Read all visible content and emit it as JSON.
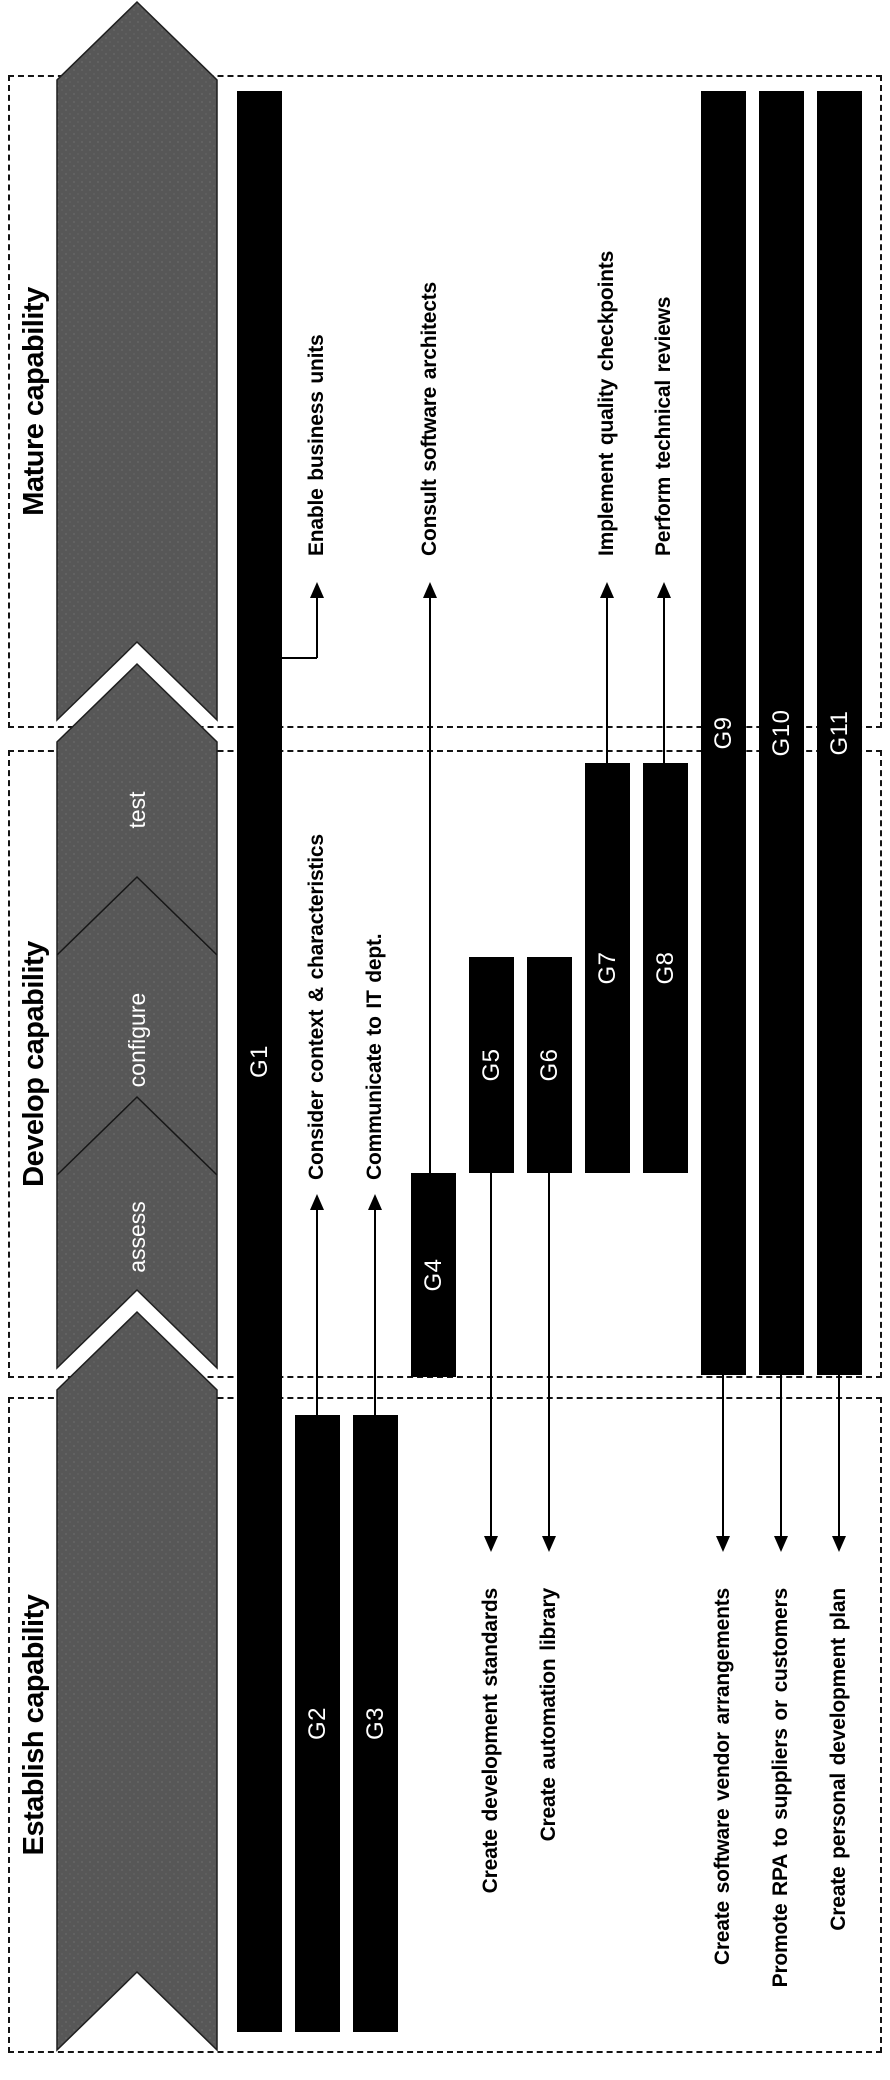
{
  "colors": {
    "background": "#ffffff",
    "arrow_gray": "#575757",
    "arrow_dot_texture": "#666666",
    "arrow_edge": "#1f1f1f",
    "bar_fill": "#000000",
    "bar_label_color": "#ffffff",
    "dashed_border": "#141414",
    "text_color": "#000000"
  },
  "phases": [
    {
      "id": "establish",
      "label": "Establish capability",
      "sub_phases": []
    },
    {
      "id": "develop",
      "label": "Develop capability",
      "sub_phases": [
        "assess",
        "configure",
        "test"
      ]
    },
    {
      "id": "mature",
      "label": "Mature capability",
      "sub_phases": []
    }
  ],
  "bars": [
    {
      "id": "G1",
      "label": "G1",
      "x": 48,
      "width": 1941,
      "y": 237
    },
    {
      "id": "G2",
      "label": "G2",
      "x": 48,
      "width": 617,
      "y": 295
    },
    {
      "id": "G3",
      "label": "G3",
      "x": 48,
      "width": 617,
      "y": 353
    },
    {
      "id": "G4",
      "label": "G4",
      "x": 703,
      "width": 204,
      "y": 411
    },
    {
      "id": "G5",
      "label": "G5",
      "x": 907,
      "width": 216,
      "y": 469
    },
    {
      "id": "G6",
      "label": "G6",
      "x": 907,
      "width": 216,
      "y": 527
    },
    {
      "id": "G7",
      "label": "G7",
      "x": 907,
      "width": 410,
      "y": 585
    },
    {
      "id": "G8",
      "label": "G8",
      "x": 907,
      "width": 410,
      "y": 643
    },
    {
      "id": "G9",
      "label": "G9",
      "x": 705,
      "width": 1284,
      "y": 701
    },
    {
      "id": "G10",
      "label": "G10",
      "x": 705,
      "width": 1284,
      "y": 759
    },
    {
      "id": "G11",
      "label": "G11",
      "x": 705,
      "width": 1284,
      "y": 817
    }
  ],
  "annotations": [
    {
      "id": "enable-business-units",
      "bar": "G1",
      "text": "Enable business units",
      "dir": "right",
      "y": 317,
      "x_from": 1422,
      "x_tip": 1498,
      "text_x": 1524,
      "elbow_from_y": 282
    },
    {
      "id": "consider-context-characteristics",
      "bar": "G2",
      "text": "Consider context & characteristics",
      "dir": "right",
      "y": 317,
      "x_from": 665,
      "x_tip": 886,
      "text_x": 900
    },
    {
      "id": "communicate-to-it-dept",
      "bar": "G3",
      "text": "Communicate to IT dept.",
      "dir": "right",
      "y": 375,
      "x_from": 665,
      "x_tip": 886,
      "text_x": 900
    },
    {
      "id": "consult-software-architects",
      "bar": "G4",
      "text": "Consult software architects",
      "dir": "right",
      "y": 430,
      "x_from": 907,
      "x_tip": 1498,
      "text_x": 1524
    },
    {
      "id": "implement-quality-checkpoints",
      "bar": "G7",
      "text": "Implement quality checkpoints",
      "dir": "right",
      "y": 607,
      "x_from": 1317,
      "x_tip": 1498,
      "text_x": 1524
    },
    {
      "id": "perform-technical-reviews",
      "bar": "G8",
      "text": "Perform technical reviews",
      "dir": "right",
      "y": 664,
      "x_from": 1317,
      "x_tip": 1498,
      "text_x": 1524
    },
    {
      "id": "create-development-standards",
      "bar": "G5",
      "text": "Create development standards",
      "dir": "left",
      "y": 491,
      "x_from": 907,
      "x_tip": 528,
      "text_x": 492
    },
    {
      "id": "create-automation-library",
      "bar": "G6",
      "text": "Create automation library",
      "dir": "left",
      "y": 549,
      "x_from": 907,
      "x_tip": 528,
      "text_x": 492
    },
    {
      "id": "create-software-vendor-arrangements",
      "bar": "G9",
      "text": "Create software vendor arrangements",
      "dir": "left",
      "y": 723,
      "x_from": 705,
      "x_tip": 528,
      "text_x": 492
    },
    {
      "id": "promote-rpa-to-suppliers-or-customers",
      "bar": "G10",
      "text": "Promote RPA to suppliers or customers",
      "dir": "left",
      "y": 781,
      "x_from": 705,
      "x_tip": 528,
      "text_x": 492
    },
    {
      "id": "create-personal-development-plan",
      "bar": "G11",
      "text": "Create personal development plan",
      "dir": "left",
      "y": 839,
      "x_from": 705,
      "x_tip": 528,
      "text_x": 492
    }
  ]
}
